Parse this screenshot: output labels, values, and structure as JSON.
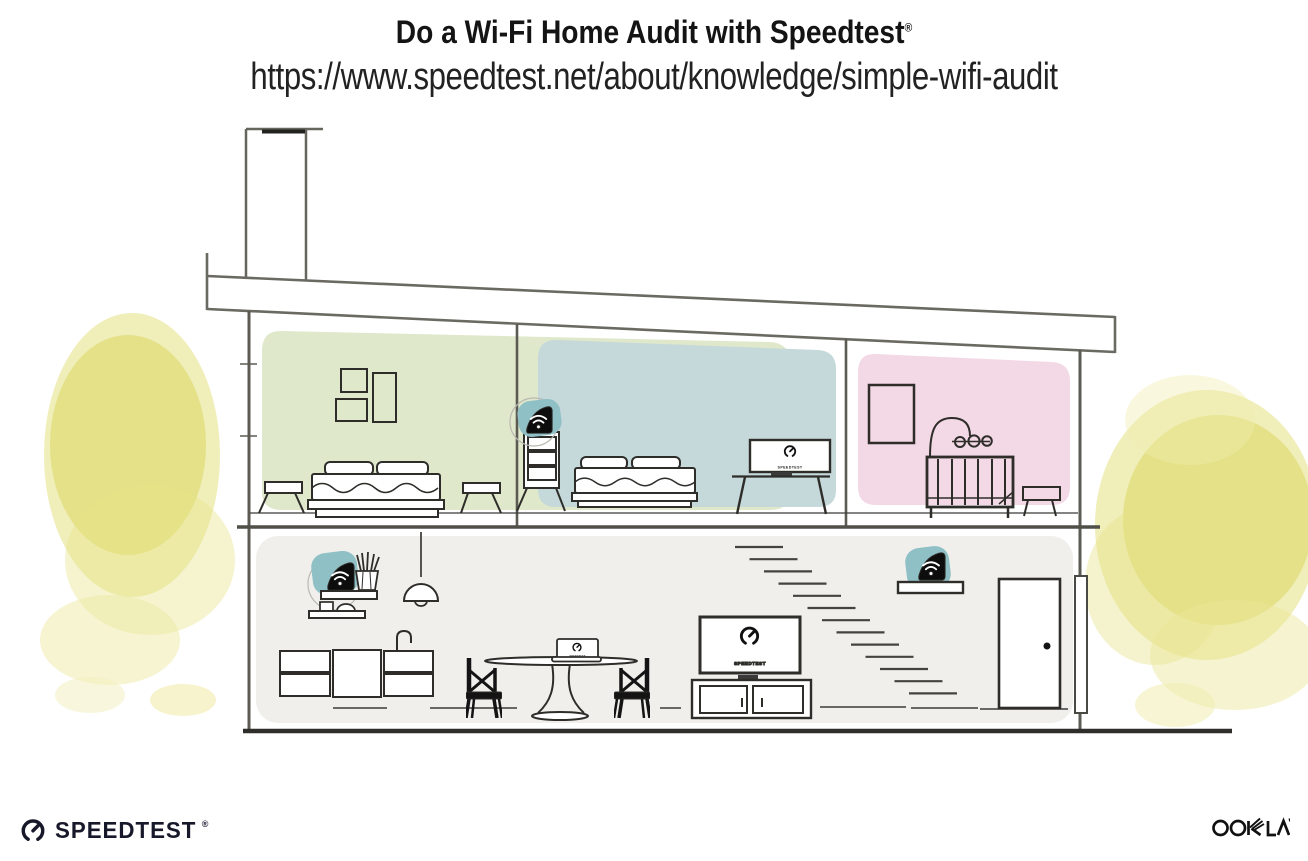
{
  "header": {
    "title": "Do a Wi-Fi Home Audit with Speedtest",
    "registered_mark": "®",
    "url": "https://www.speedtest.net/about/knowledge/simple-wifi-audit"
  },
  "screens": {
    "label": "SPEEDTEST"
  },
  "footer": {
    "speedtest_wordmark": "SPEEDTEST",
    "speedtest_registered": "®",
    "ookla_wordmark": "OOKLA"
  },
  "palette": {
    "room_green": "#dfe8cb",
    "room_blue": "#c5d8da",
    "room_pink": "#f3d8e6",
    "ground_floor_gray": "#f0efec",
    "tree_yellow": "#e1dd74",
    "device_teal": "#8fc0c6",
    "line_ink": "#2e2d2a",
    "wall_gray": "#5c5b53"
  },
  "house": {
    "upper_rooms": [
      {
        "name": "green-bedroom"
      },
      {
        "name": "blue-bedroom"
      },
      {
        "name": "pink-nursery"
      }
    ],
    "wifi_devices": [
      {
        "name": "mesh-point-on-bedroom-dresser"
      },
      {
        "name": "router-on-kitchen-shelf"
      },
      {
        "name": "mesh-point-on-entry-shelf"
      }
    ]
  }
}
